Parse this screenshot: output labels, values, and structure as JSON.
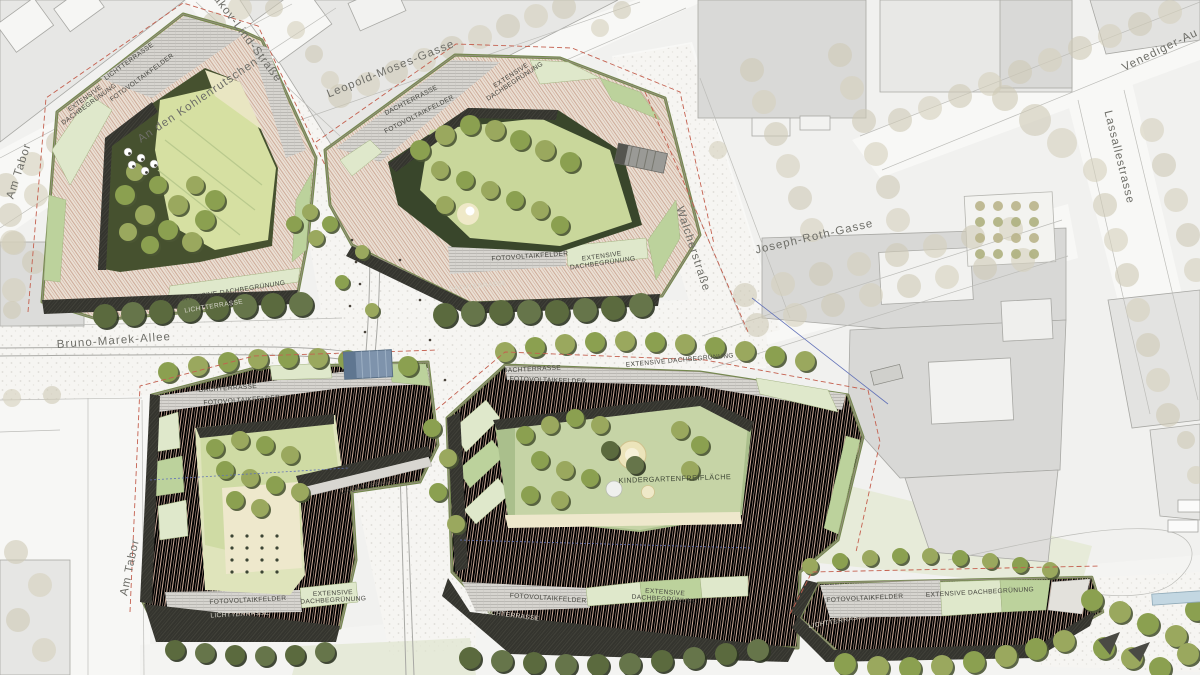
{
  "plan": {
    "title": "Nordbahnhof quarter site plan",
    "streets": {
      "an_den_kohlenrutschen": "An den Kohlenrutschen",
      "am_tabor": "Am Tabor",
      "jakov_lind_strasse": "Jakov-Lind-Straße",
      "leopold_moses_gasse": "Leopold-Moses-Gasse",
      "venediger_au_park": "Venediger-Au Park",
      "lassallestrasse": "Lassallestrasse",
      "walcherstrasse": "Walcherstraße",
      "joseph_roth_gasse": "Joseph-Roth-Gasse",
      "bruno_marek_allee": "Bruno-Marek-Allee"
    },
    "roofs": {
      "lichtterrasse": "LICHTTERRASSE",
      "dachterrasse": "DACHTERRASSE",
      "fotovoltaikfelder": "FOTOVOLTAIKFELDER",
      "extensive": "EXTENSIVE",
      "dachbegruenung": "DACHBEGRÜNUNG",
      "extensive_dachbegruenung": "EXTENSIVE DACHBEGRÜNUNG",
      "kindergartenfreiflaeche": "KINDERGARTENFREIFLÄCHE"
    },
    "colors": {
      "context_bg": "#f1f1ef",
      "street": "#f8f8f6",
      "context_building": "#dcdcda",
      "context_tree": "#cfc9b6",
      "roof_stripe": "#e9dccf",
      "roof_pv": "#d6d4cf",
      "roof_green_light": "#dfe8cb",
      "roof_green_mid": "#bcd29c",
      "facade_dark": "#34342e",
      "courtyard_dark_green": "#46512f",
      "lawn": "#d6e0a2",
      "tree_olive": "#9aa85e",
      "boundary_red": "#c4604f",
      "line_blue": "#6272b8",
      "canopy_blue": "#7e93ac",
      "water": "#c3d7e2"
    }
  }
}
